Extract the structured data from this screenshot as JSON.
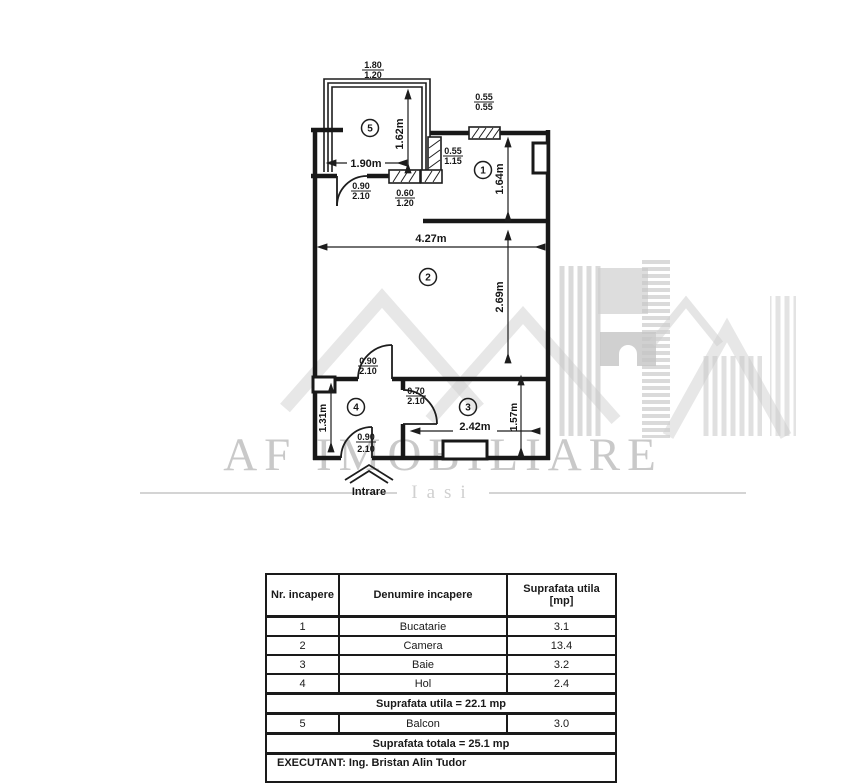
{
  "watermark": {
    "brand": "AF IMOBILIARE",
    "city": "Iasi"
  },
  "plan": {
    "room_numbers": {
      "balcony": "5",
      "kitchen": "1",
      "camera": "2",
      "baie": "3",
      "hol": "4"
    },
    "entrance_label": "Intrare",
    "dims": {
      "balcony_width": "1.90m",
      "balcony_depth": "1.62m",
      "kitchen_height": "1.64m",
      "room_width": "4.27m",
      "room_height": "2.69m",
      "hall_height": "1.31m",
      "bath_width": "2.42m",
      "bath_height": "1.57m"
    },
    "fractions": {
      "balcony_window": {
        "top": "1.80",
        "bottom": "1.20"
      },
      "kitchen_top_window": {
        "top": "0.55",
        "bottom": "0.55"
      },
      "kitchen_side_window": {
        "top": "0.55",
        "bottom": "1.15"
      },
      "balcony_door": {
        "top": "0.90",
        "bottom": "2.10"
      },
      "balcony_small_window": {
        "top": "0.60",
        "bottom": "1.20"
      },
      "hall_door": {
        "top": "0.90",
        "bottom": "2.10"
      },
      "bath_door": {
        "top": "0.70",
        "bottom": "2.10"
      },
      "entry_door": {
        "top": "0.90",
        "bottom": "2.10"
      }
    }
  },
  "table": {
    "headers": {
      "col1": "Nr. incapere",
      "col2": "Denumire incapere",
      "col3a": "Suprafata utila",
      "col3b": "[mp]"
    },
    "rows": [
      {
        "nr": "1",
        "name": "Bucatarie",
        "area": "3.1"
      },
      {
        "nr": "2",
        "name": "Camera",
        "area": "13.4"
      },
      {
        "nr": "3",
        "name": "Baie",
        "area": "3.2"
      },
      {
        "nr": "4",
        "name": "Hol",
        "area": "2.4"
      }
    ],
    "subtotal": "Suprafata utila = 22.1 mp",
    "row5": {
      "nr": "5",
      "name": "Balcon",
      "area": "3.0"
    },
    "total": "Suprafata totala = 25.1 mp",
    "executant": "EXECUTANT: Ing. Bristan Alin Tudor"
  },
  "colors": {
    "line": "#181818",
    "watermark_gray": "#c9c9c9"
  }
}
